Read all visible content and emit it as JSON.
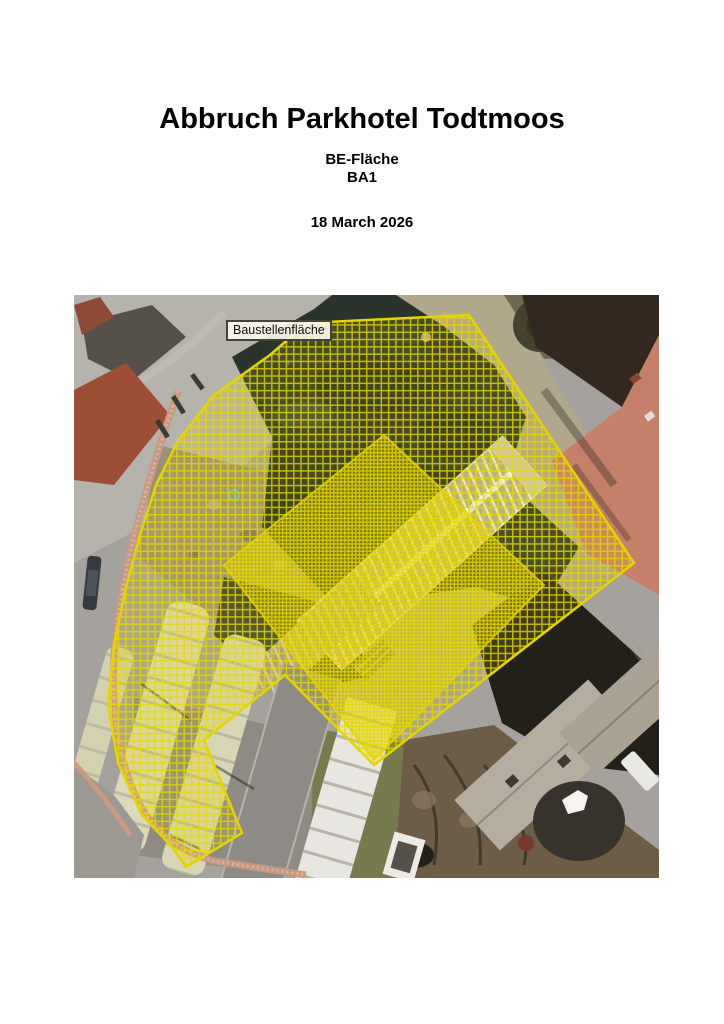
{
  "document": {
    "title": "Abbruch Parkhotel Todtmoos",
    "subtitle_line1": "BE-Fläche",
    "subtitle_line2": "BA1",
    "date": "18 March 2026"
  },
  "map": {
    "area_label": "Baustellenfläche",
    "overlay": {
      "border_color": "#e4d400",
      "hatch_color": "#e8da00"
    }
  }
}
